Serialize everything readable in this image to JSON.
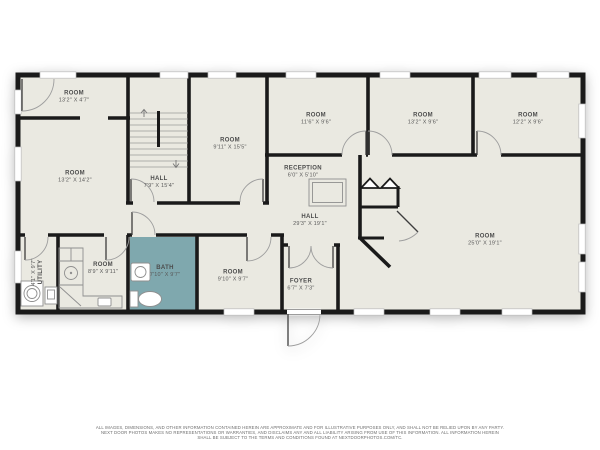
{
  "meta": {
    "type": "floor-plan"
  },
  "colors": {
    "floor": "#eae9e1",
    "bath": "#7fa8ae",
    "wall": "#1a1a1a",
    "fixture": "#8f8f8f",
    "label": "#4c4c4c",
    "disclaimer": "#6e6e6e"
  },
  "rooms": {
    "room_a": {
      "name": "ROOM",
      "dims": "13'2\" X 4'7\""
    },
    "room_b": {
      "name": "ROOM",
      "dims": "13'2\" X 14'2\""
    },
    "stair_hall": {
      "name": "HALL",
      "dims": "7'9\" X 15'4\""
    },
    "room_c": {
      "name": "ROOM",
      "dims": "9'11\" X 15'5\""
    },
    "reception": {
      "name": "RECEPTION",
      "dims": "6'0\" X 5'10\""
    },
    "room_d": {
      "name": "ROOM",
      "dims": "11'6\" X 9'6\""
    },
    "room_e": {
      "name": "ROOM",
      "dims": "13'2\" X 9'6\""
    },
    "room_f": {
      "name": "ROOM",
      "dims": "12'2\" X 9'6\""
    },
    "hall": {
      "name": "HALL",
      "dims": "29'3\" X 19'1\""
    },
    "room_g": {
      "name": "ROOM",
      "dims": "25'0\" X 19'1\""
    },
    "utility": {
      "name": "UTILITY",
      "dims": "4'1\" X 9'7\""
    },
    "kitchen": {
      "name": "ROOM",
      "dims": "8'9\" X 9'11\""
    },
    "bath": {
      "name": "BATH",
      "dims": "7'10\" X 9'7\""
    },
    "room_h": {
      "name": "ROOM",
      "dims": "9'10\" X 9'7\""
    },
    "foyer": {
      "name": "FOYER",
      "dims": "6'7\" X 7'3\""
    }
  },
  "disclaimer": {
    "line1": "ALL IMAGES, DIMENSIONS, AND OTHER INFORMATION CONTAINED HEREIN ARE APPROXIMATE AND FOR ILLUSTRATIVE PURPOSES ONLY, AND SHALL NOT BE RELIED UPON BY ANY PARTY.",
    "line2": "NEXT DOOR PHOTOS MAKES NO REPRESENTATIONS OR WARRANTIES, AND DISCLAIMS ANY AND ALL LIABILITY ARISING FROM USE OF THIS INFORMATION. ALL INFORMATION HEREIN",
    "line3": "SHALL BE SUBJECT TO THE TERMS AND CONDITIONS FOUND AT NEXTDOORPHOTOS.COM/TC."
  }
}
